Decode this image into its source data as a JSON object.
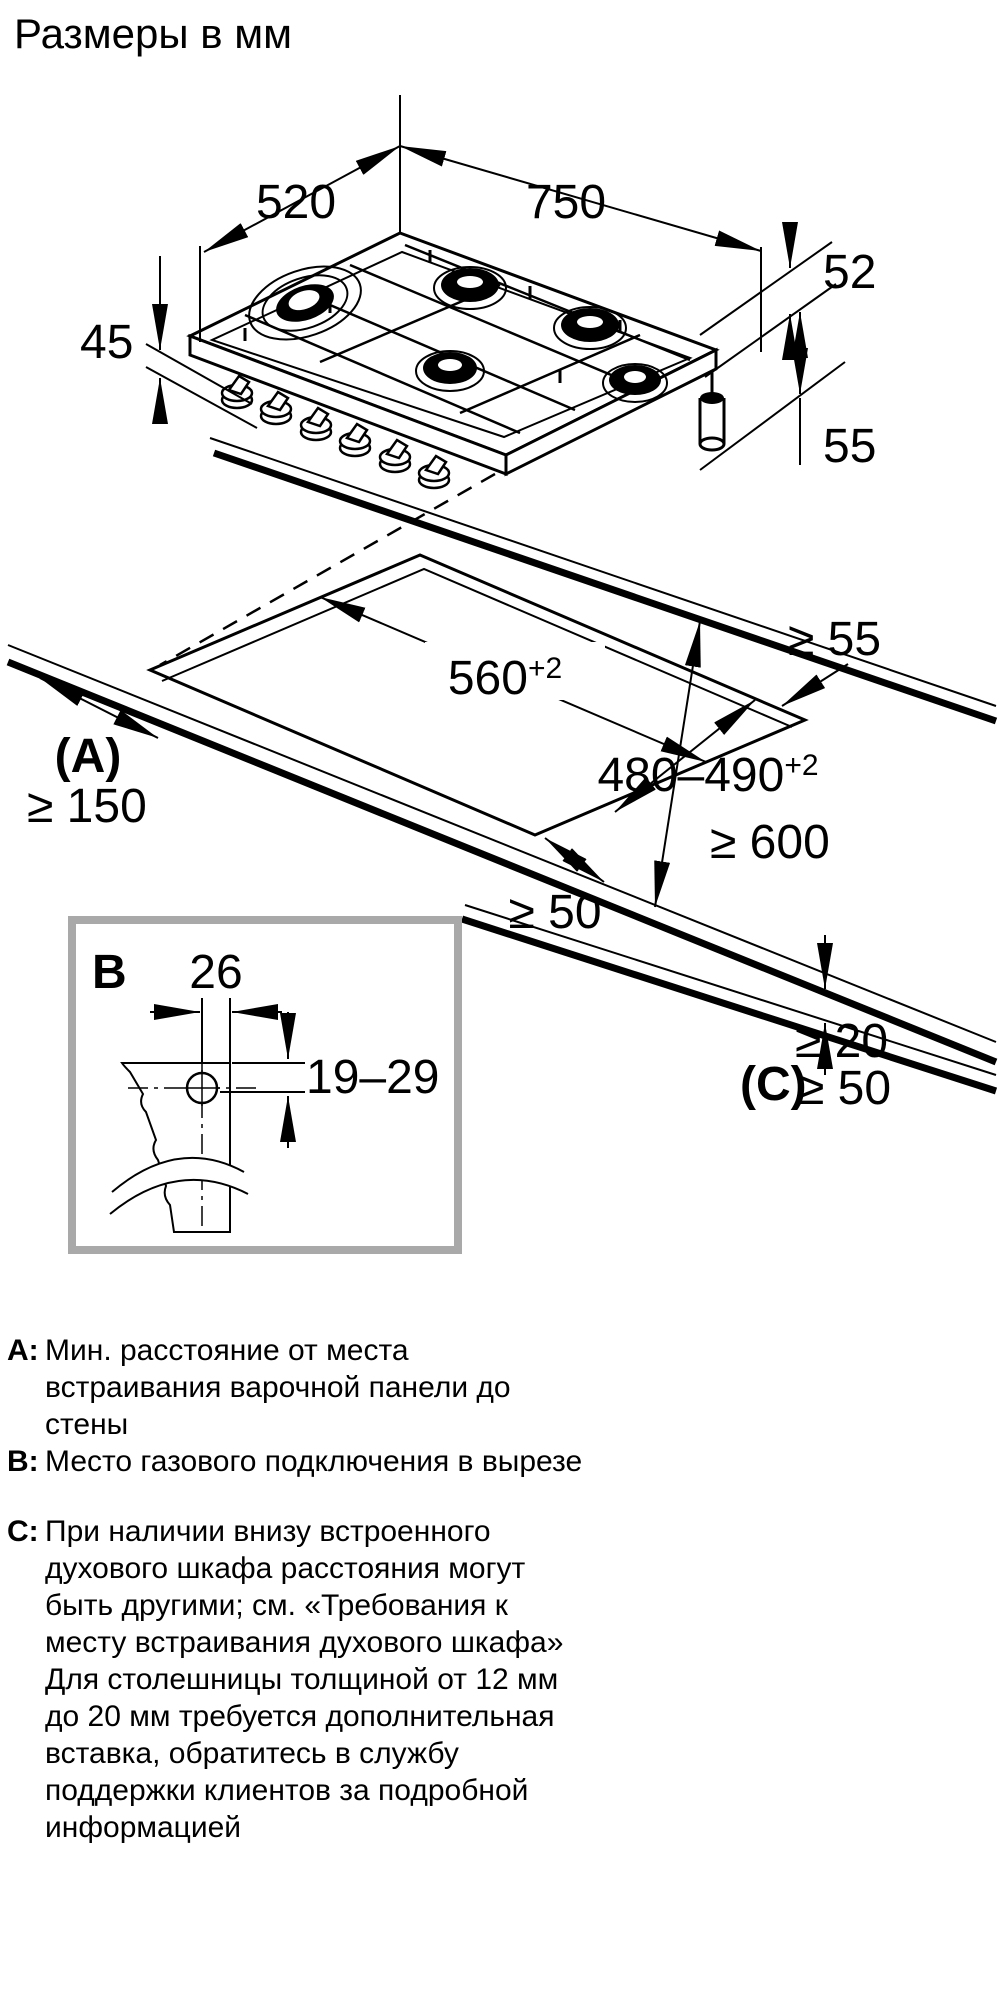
{
  "title": "Размеры в мм",
  "dims": {
    "hob_depth": "520",
    "hob_width": "750",
    "hob_edge": "52",
    "hob_left": "45",
    "hob_height": "55",
    "wall_rear": "≥ 55",
    "cutout_width": "560",
    "cutout_width_sup": "+2",
    "cutout_depth": "480–490",
    "cutout_depth_sup": "+2",
    "a_ref": "(A)",
    "wall_side": "≥ 150",
    "worktop_depth": "≥ 600",
    "front_gap": "≥ 50",
    "c_ref": "(C)",
    "c_top": "≥ 20",
    "c_bottom": "≥ 50",
    "detail_ref": "B",
    "detail_hole_offset": "26",
    "detail_hole_depth": "19–29"
  },
  "legend": {
    "items": [
      {
        "key": "A:",
        "text": "Мин. расстояние от места\nвстраивания варочной панели до\nстены"
      },
      {
        "key": "B:",
        "text": "Место газового подключения в вырезе"
      },
      {
        "key": "C:",
        "text": "При наличии внизу встроенного\nдухового шкафа расстояния могут\nбыть другими; см. «Требования к\nместу встраивания духового шкафа»\nДля столешницы толщиной от 12 мм\nдо 20 мм требуется дополнительная\nвставка, обратитесь в службу\nподдержки клиентов за подробной\nинформацией"
      }
    ]
  }
}
